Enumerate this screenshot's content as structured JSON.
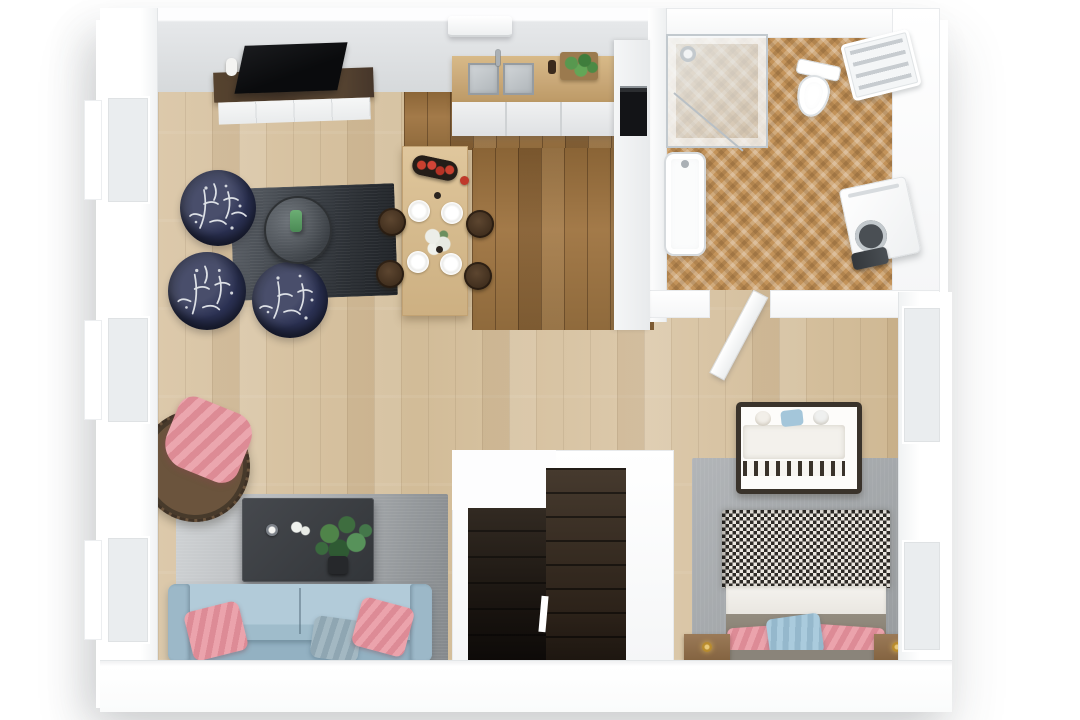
{
  "scene": {
    "title": "Top-down 3D render of a furnished apartment floor plan",
    "view": "cut-away bird's-eye 3D visualization, no text labels",
    "background": "#ffffff"
  },
  "palette": {
    "wall_white": "#f5f6f7",
    "wall_inner_shade": "#d6d9db",
    "floor_light_oak": "#d8c5a6",
    "floor_kitchen_walnut": "#9b7445",
    "floor_bath_herringbone": "#c3935a",
    "rug_charcoal": "#33373c",
    "rug_grey_ombre": "#a9adb0",
    "rug_bedroom_grey": "#a2a6a9",
    "sofa_blue": "#a9c3d2",
    "pillow_pink": "#e28f99",
    "pillow_blue": "#9fc2d5",
    "pouf_navy": "#1f2438",
    "stairs_dark_wood": "#2e2620",
    "dining_table_wood": "#d9be93",
    "counter_wood": "#c9a878",
    "cabinet_grey_white": "#eceeef",
    "tv_black": "#0c0d0f",
    "sideboard_walnut": "#4e3d2c",
    "plant_green": "#4f8449",
    "apple_red": "#c0392b",
    "crib_frame": "#3a332b",
    "bed_runner_grey": "#8e887c",
    "nightstand_wood": "#8a6a4c",
    "lamp_brass": "#c9a24a",
    "fixture_white": "#ffffff",
    "chrome": "#b9c0c5"
  },
  "rooms": {
    "living_room": {
      "label": "Living room",
      "floor": "light oak planks",
      "items": [
        "flat-screen TV on walnut media sideboard",
        "white decor vase",
        "three navy botanical-print poufs",
        "round glass side table with green vase",
        "charcoal rug",
        "rattan hanging egg chair with pink throw",
        "grey ombre rug",
        "dark grey coffee table with potted plants and candle",
        "light blue sofa with two pink cushions and one blue-grey cushion"
      ]
    },
    "kitchen": {
      "label": "Kitchen",
      "floor": "dark walnut planks",
      "items": [
        "wood worktop with double stainless sink and chrome tap",
        "herb planter box",
        "light grey base cabinets",
        "tall cabinet with built-in black oven",
        "wall-mounted AC unit above"
      ]
    },
    "dining_area": {
      "label": "Dining area",
      "items": [
        "light wood dining table",
        "four dark wooden stools",
        "oval tray with red apples",
        "four white plate place settings",
        "white hydrangea centrepiece"
      ]
    },
    "bathroom": {
      "label": "Bathroom",
      "floor": "herringbone parquet",
      "items": [
        "corner glass shower",
        "white bathtub",
        "wall-hung toilet",
        "white towel radiator",
        "washing machine with dark laundry items",
        "open white door"
      ]
    },
    "bedroom": {
      "label": "Bedroom",
      "floor": "light oak planks",
      "items": [
        "baby cot with white bedding and pastel pillows",
        "grey area rug",
        "double bed with houndstooth throw, white sheet band and grey runner",
        "two pink pillows and one blue pillow",
        "grey headboard",
        "two wooden nightstands with brass lamps",
        "windows in right wall"
      ]
    },
    "staircase": {
      "label": "Staircase",
      "items": [
        "dark timber winder stairs leading down",
        "white stairwell walls"
      ]
    }
  }
}
